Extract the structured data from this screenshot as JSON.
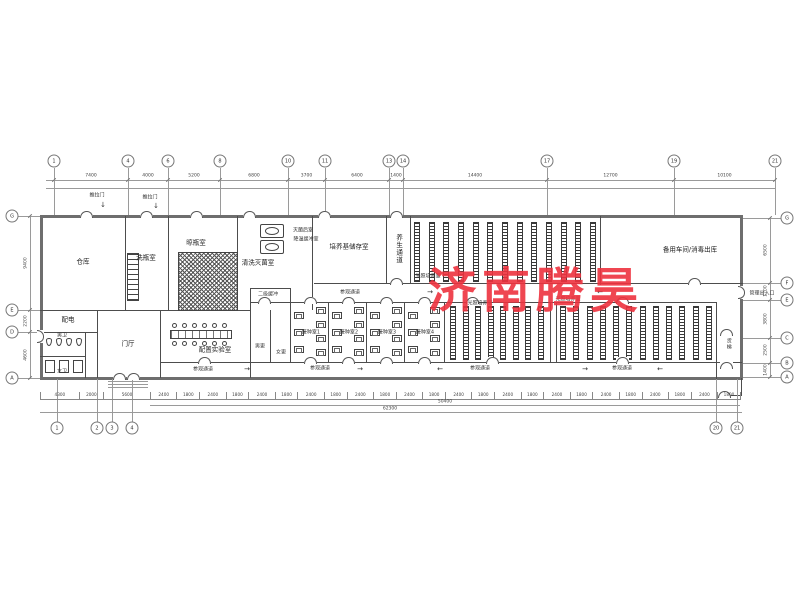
{
  "watermark": {
    "text": "济南腾昊",
    "color": "#ee333f"
  },
  "rooms": {
    "cangku": "仓库",
    "xiping": "洗瓶室",
    "liangping": "晾瓶室",
    "qingxi": "清洗灭菌室",
    "peiyangji": "培养基储存室",
    "yangsheng": "养生通道",
    "guangzhao_top": "光照培养室",
    "beiyong": "备用车间/消毒出库",
    "peidian": "配电",
    "nanwei": "男卫",
    "nvwei": "女卫",
    "menting": "门厅",
    "peizhi": "配置实验室",
    "erji": "二级缓冲",
    "nangeng": "男更",
    "nvgeng": "女更",
    "jiezhong": [
      "接种室1",
      "接种室2",
      "接种室3",
      "接种室4"
    ],
    "guangzhao_a": "光照培养室",
    "guangzhao_b": "光照培养室",
    "canguan": "参观通道",
    "huoti": "货梯"
  },
  "labels": {
    "tuilamen": "推拉门",
    "miejunhou": "灭菌后室",
    "huanchong": "降温缓冲室",
    "guanli": "管理出入口"
  },
  "icons": {
    "arrow_right": "→",
    "arrow_left": "←",
    "arrow_down": "↓"
  },
  "grid": {
    "top": [
      {
        "n": "1",
        "x": 54
      },
      {
        "n": "4",
        "x": 128
      },
      {
        "n": "6",
        "x": 168
      },
      {
        "n": "8",
        "x": 220
      },
      {
        "n": "10",
        "x": 288
      },
      {
        "n": "11",
        "x": 325
      },
      {
        "n": "13",
        "x": 389
      },
      {
        "n": "14",
        "x": 403
      },
      {
        "n": "17",
        "x": 547
      },
      {
        "n": "19",
        "x": 674
      },
      {
        "n": "21",
        "x": 775
      }
    ],
    "bottom": [
      {
        "n": "1",
        "x": 57
      },
      {
        "n": "2",
        "x": 97
      },
      {
        "n": "3",
        "x": 112
      },
      {
        "n": "4",
        "x": 132
      },
      {
        "n": "20",
        "x": 716
      },
      {
        "n": "21",
        "x": 737
      }
    ],
    "left": [
      {
        "l": "G",
        "y": 216
      },
      {
        "l": "E",
        "y": 310
      },
      {
        "l": "D",
        "y": 332
      },
      {
        "l": "A",
        "y": 378
      }
    ],
    "right": [
      {
        "l": "G",
        "y": 218
      },
      {
        "l": "F",
        "y": 283
      },
      {
        "l": "E",
        "y": 300
      },
      {
        "l": "C",
        "y": 338
      },
      {
        "l": "B",
        "y": 363
      },
      {
        "l": "A",
        "y": 377
      }
    ]
  },
  "dims": {
    "top": [
      "7400",
      "4000",
      "5200",
      "6800",
      "3700",
      "6400",
      "1400",
      "14400",
      "12700",
      "10100"
    ],
    "bottom_left": [
      "4300",
      "2000",
      "5600"
    ],
    "bottom_chain": [
      "2400",
      "1800",
      "2400",
      "1800",
      "2400",
      "1800",
      "2400",
      "1800",
      "2400",
      "1800",
      "2400",
      "1800",
      "2400",
      "1800",
      "2400",
      "1800",
      "2400",
      "1800",
      "2400",
      "1800",
      "2400",
      "1800",
      "2400",
      "1800"
    ],
    "bottom_subtotal": "50400",
    "bottom_total": "62300",
    "left": [
      {
        "v": "9400",
        "y": 263
      },
      {
        "v": "2200",
        "y": 321
      },
      {
        "v": "4600",
        "y": 355
      }
    ],
    "right": [
      {
        "v": "6500",
        "y": 250
      },
      {
        "v": "1700",
        "y": 291
      },
      {
        "v": "3800",
        "y": 319
      },
      {
        "v": "2500",
        "y": 350
      },
      {
        "v": "1400",
        "y": 370
      }
    ]
  },
  "racks": {
    "top": 13,
    "bottomA": 8,
    "bottomB": 12
  },
  "equip": {
    "inoc_left": 3,
    "inoc_right": 4,
    "stools": 6,
    "urinals": 4,
    "stalls": 3
  },
  "colors": {
    "wall": "#6e6e6e",
    "line": "#9a9a9a",
    "watermark": "#ee333f"
  }
}
